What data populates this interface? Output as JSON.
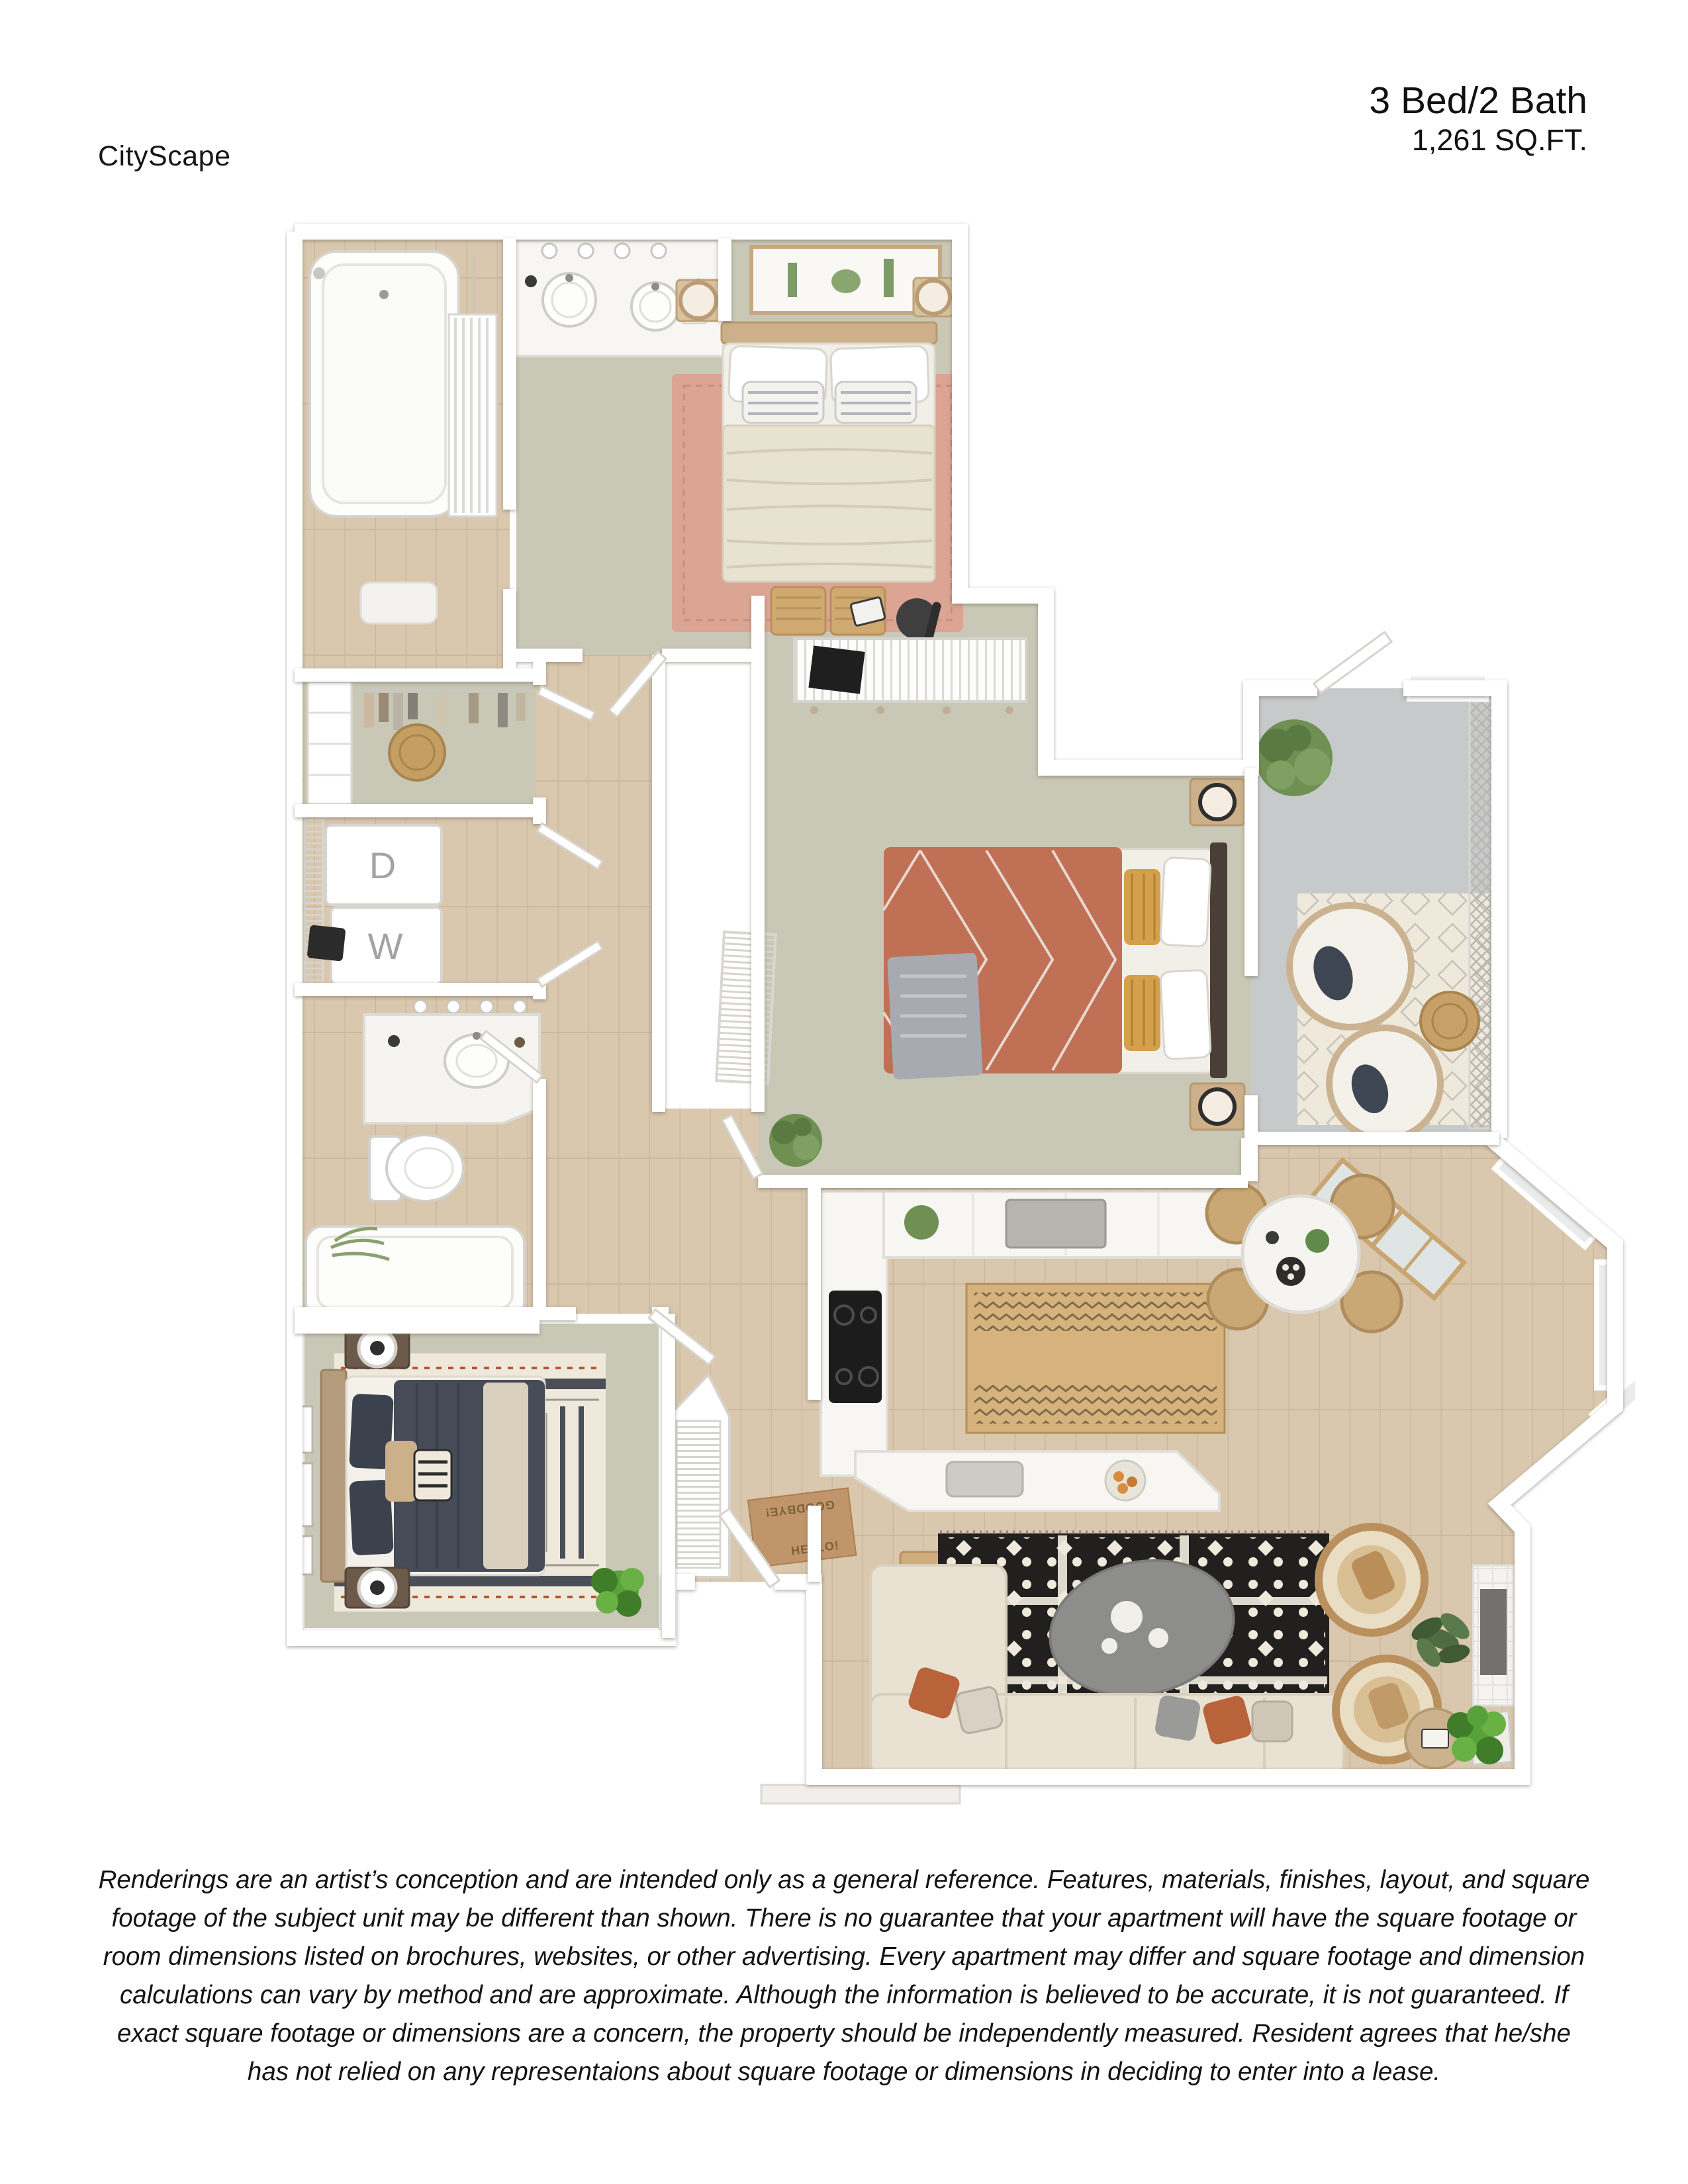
{
  "page": {
    "brand": "CityScape",
    "unit_type": "3 Bed/2 Bath",
    "area": "1,261 SQ.FT."
  },
  "floor_plan": {
    "labels": {
      "dryer": "D",
      "washer": "W",
      "doormat_top": "GOODBYE!",
      "doormat_bottom": "HELLO!"
    },
    "rooms": [
      "master-bathroom",
      "master-bedroom",
      "walk-in-closet",
      "laundry",
      "bathroom",
      "hallway",
      "bedroom-2",
      "patio",
      "kitchen",
      "dining-nook",
      "living-room",
      "bedroom-3",
      "entry"
    ],
    "colors": {
      "wall": "#ffffff",
      "carpet": "#c9c8b6",
      "wood_floor": "#d9c7ae",
      "patio_concrete": "#c7caca",
      "rug_terracotta": "#dca493",
      "bed_rust": "#c07055",
      "bed_navy": "#454b57",
      "rug_black": "#22201f",
      "rug_cream": "#efe9dc",
      "kitchen_runner": "#d6b27c",
      "sofa_cream": "#e9e2d2",
      "accent_orange": "#b8633a",
      "plant_green": "#6f8f53",
      "plant_bright": "#58a23b",
      "wicker_tan": "#c9a876",
      "counter_white": "#f7f6f3",
      "mat_tan": "#c0956a"
    }
  },
  "disclaimer": {
    "lines": [
      "Renderings are an artist’s conception and are intended only as a general reference. Features, materials, finishes, layout, and square",
      "footage of the subject unit may be different than shown. There is no guarantee that your apartment will have the square footage or",
      "room dimensions listed on brochures, websites, or other advertising. Every apartment may differ and square footage and dimension",
      "calculations can vary by method and are approximate. Although the information is believed to be accurate, it is not guaranteed. If",
      "exact square footage or dimensions are a concern, the property should be independently measured. Resident agrees that he/she",
      "has not relied on any representaions about square footage or dimensions in deciding to enter into a lease."
    ]
  }
}
